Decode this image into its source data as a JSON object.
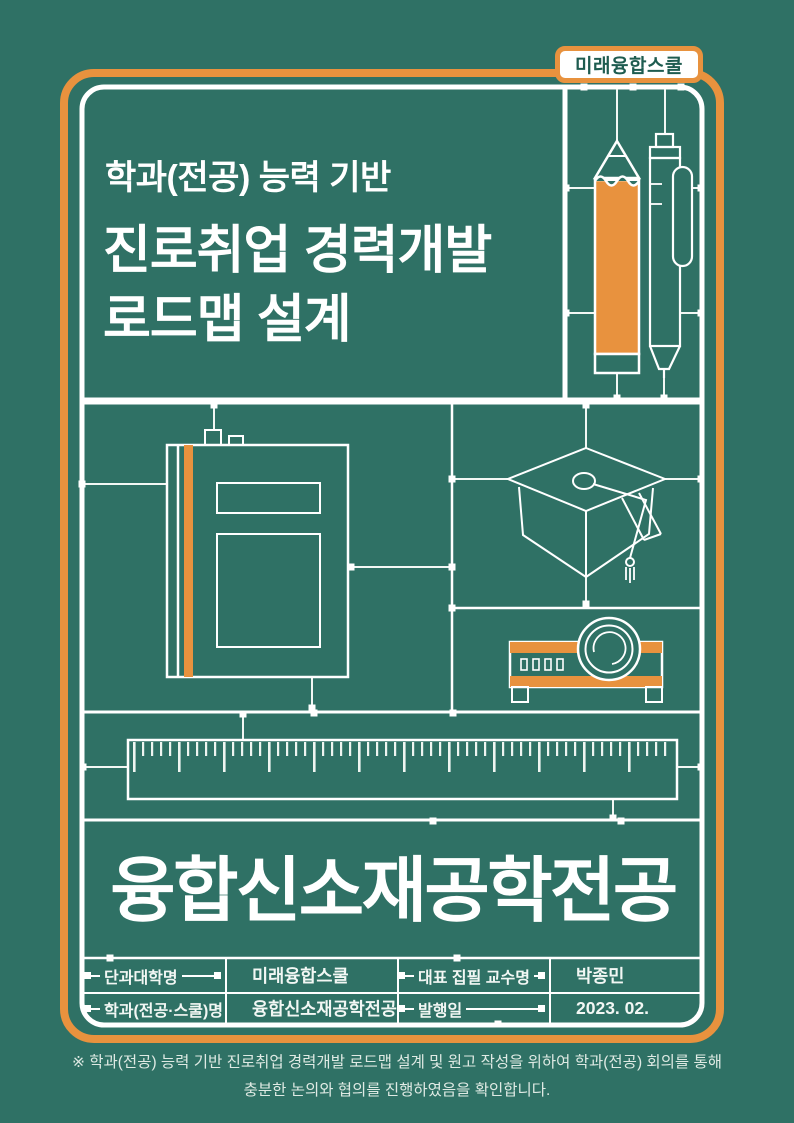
{
  "page": {
    "background_color": "#2F7165",
    "accent_color": "#E8923E",
    "line_color": "#FFFFFF",
    "badge_text_color": "#1E5C50"
  },
  "badge": {
    "label": "미래융합스쿨"
  },
  "title": {
    "eyebrow": "학과(전공) 능력 기반",
    "line1": "진로취업 경력개발",
    "line2": "로드맵 설계"
  },
  "major": {
    "name": "융합신소재공학전공"
  },
  "info_table": {
    "rows": [
      {
        "label_left": "단과대학명",
        "value_left": "미래융합스쿨",
        "label_right": "대표 집필 교수명",
        "value_right": "박종민"
      },
      {
        "label_left": "학과(전공·스쿨)명",
        "value_left": "융합신소재공학전공",
        "label_right": "발행일",
        "value_right": "2023. 02."
      }
    ]
  },
  "footer": {
    "line1": "※ 학과(전공) 능력 기반 진로취업 경력개발 로드맵 설계 및 원고 작성을 위하여 학과(전공) 회의를 통해",
    "line2": "충분한 논의와 협의를 진행하였음을 확인합니다."
  },
  "illustrations": {
    "items": [
      "pencil",
      "pen",
      "notebook",
      "graduation-cap",
      "projector",
      "ruler"
    ]
  }
}
